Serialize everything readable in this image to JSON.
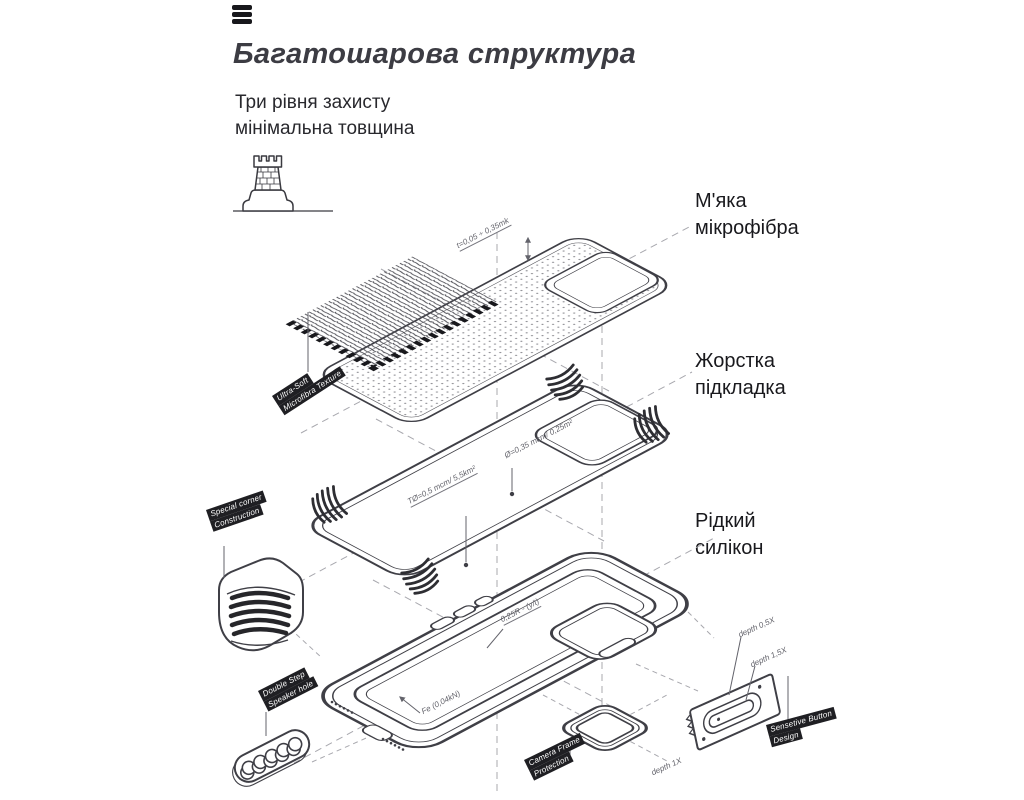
{
  "header": {
    "title": "Багатошарова структура",
    "subtitle1": "Три рівня захисту",
    "subtitle2": "мінімальна товщина"
  },
  "layer_labels": {
    "microfiber": {
      "line1": "М'яка",
      "line2": "мікрофібра"
    },
    "liner": {
      "line1": "Жорстка",
      "line2": "підкладка"
    },
    "silicone": {
      "line1": "Рідкий",
      "line2": "силікон"
    }
  },
  "tags": {
    "microfiber": {
      "line1": "Ultra-Soft",
      "line2": "Microfibra Texture"
    },
    "corner": {
      "line1": "Special corner",
      "line2": "Construction"
    },
    "speaker": {
      "line1": "Double Step",
      "line2": "Speaker hole"
    },
    "camera": {
      "line1": "Camera Frame",
      "line2": "Protection"
    },
    "button": {
      "line1": "Sensetive Button",
      "line2": "Design"
    }
  },
  "dimensions": {
    "thickness": "t=0,05 ÷ 0,35mk",
    "camera_spec": "Ø=0,35 mcm/ 0,25m²",
    "plate_spec": "TØ=0,5 mcm/ 5,5km²",
    "radius_spec": "0,25R - (y/t)",
    "force_spec": "Fe (0,04kN)",
    "depth_small": "depth 0,5X",
    "depth_large": "depth 1,5X",
    "depth_unit": "depth 1X"
  },
  "icons": {
    "menu": "hamburger-menu-icon",
    "tower": "fortress-tower-icon"
  },
  "colors": {
    "line": "#3f3f46",
    "dark": "#242428",
    "dashed": "#a0a0a6",
    "title": "#3c3c43",
    "label": "#19191d",
    "tag_bg": "#1f1f23",
    "tag_text": "#ffffff",
    "dim_text": "#63636b",
    "background": "#ffffff"
  }
}
